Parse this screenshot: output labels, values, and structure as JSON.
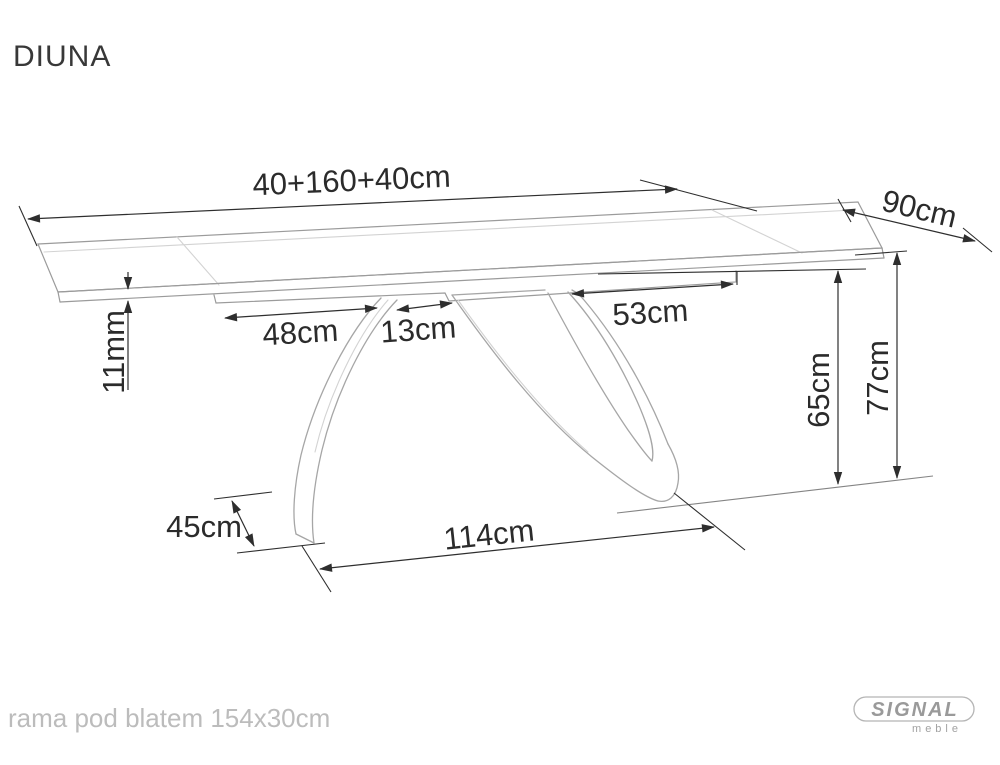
{
  "title": "DIUNA",
  "dims": {
    "top_length": "40+160+40cm",
    "top_depth": "90cm",
    "top_thickness": "11mm",
    "frame_left": "48cm",
    "frame_gap": "13cm",
    "frame_right": "53cm",
    "underside_height": "65cm",
    "total_height": "77cm",
    "foot_depth": "45cm",
    "base_span": "114cm"
  },
  "footer": {
    "note": "rama pod blatem 154x30cm"
  },
  "logo": {
    "brand": "SIGNAL",
    "subbrand": "meble"
  },
  "colors": {
    "background": "#ffffff",
    "drawing_line": "#9b9b9b",
    "leg_line": "#a6a6a6",
    "dimension_line": "#2e2e2e",
    "dimension_text": "#2b2b2b",
    "title_text": "#383838",
    "muted_note_text": "#bcbcbc",
    "logo_gray": "#9a9a9a"
  }
}
